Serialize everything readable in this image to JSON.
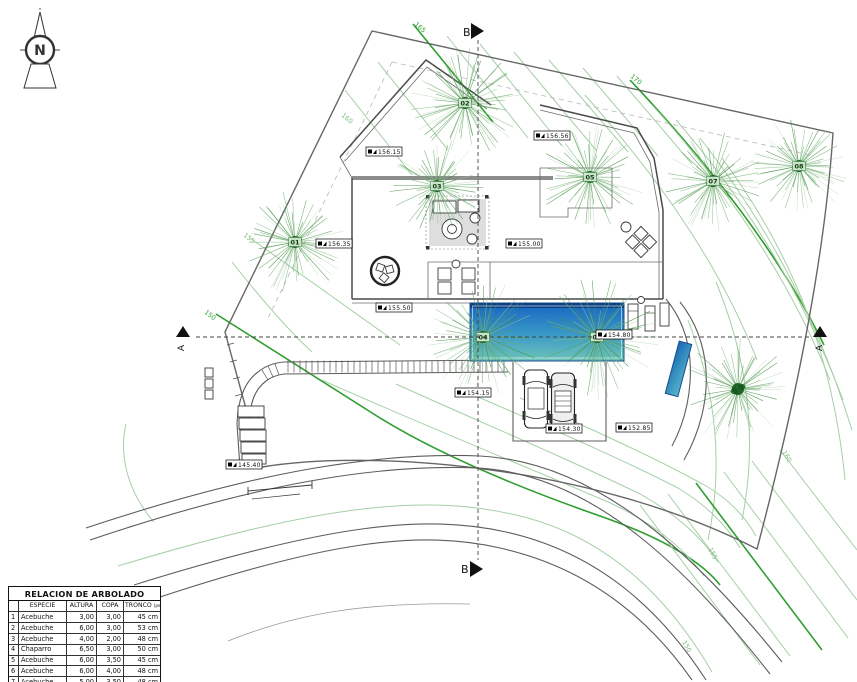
{
  "plan": {
    "compass_label": "N",
    "section_a": "A",
    "section_b": "B",
    "contour_labels": [
      {
        "text": "165",
        "x": 414,
        "y": 25,
        "bright": true,
        "rot": 40
      },
      {
        "text": "170",
        "x": 630,
        "y": 77,
        "bright": true,
        "rot": 40
      },
      {
        "text": "160",
        "x": 341,
        "y": 116,
        "bright": false,
        "rot": 40
      },
      {
        "text": "155",
        "x": 243,
        "y": 236,
        "bright": false,
        "rot": 38
      },
      {
        "text": "150",
        "x": 204,
        "y": 313,
        "bright": true,
        "rot": 38
      },
      {
        "text": "160",
        "x": 782,
        "y": 452,
        "bright": false,
        "rot": 60
      },
      {
        "text": "155",
        "x": 708,
        "y": 549,
        "bright": false,
        "rot": 62
      },
      {
        "text": "150",
        "x": 682,
        "y": 642,
        "bright": false,
        "rot": 62
      }
    ],
    "trees": [
      {
        "id": "01",
        "x": 295,
        "y": 242,
        "r": 52
      },
      {
        "id": "02",
        "x": 465,
        "y": 103,
        "r": 55
      },
      {
        "id": "03",
        "x": 437,
        "y": 186,
        "r": 48
      },
      {
        "id": "04",
        "x": 483,
        "y": 337,
        "r": 56
      },
      {
        "id": "05",
        "x": 590,
        "y": 177,
        "r": 52
      },
      {
        "id": "06",
        "x": 597,
        "y": 337,
        "r": 60
      },
      {
        "id": "07",
        "x": 713,
        "y": 181,
        "r": 50
      },
      {
        "id": "08",
        "x": 799,
        "y": 166,
        "r": 48
      },
      {
        "id": "",
        "x": 738,
        "y": 389,
        "r": 54
      }
    ],
    "elevation_labels": [
      {
        "value": "156.15",
        "x": 366,
        "y": 147
      },
      {
        "value": "156.35",
        "x": 316,
        "y": 239
      },
      {
        "value": "156.56",
        "x": 534,
        "y": 131
      },
      {
        "value": "155.00",
        "x": 506,
        "y": 239
      },
      {
        "value": "155.50",
        "x": 376,
        "y": 303
      },
      {
        "value": "154.80",
        "x": 596,
        "y": 330
      },
      {
        "value": "154.15",
        "x": 455,
        "y": 388
      },
      {
        "value": "154.30",
        "x": 546,
        "y": 424
      },
      {
        "value": "152.85",
        "x": 616,
        "y": 423
      },
      {
        "value": "145.40",
        "x": 226,
        "y": 460
      }
    ]
  },
  "table": {
    "title": "RELACION DE ARBOLADO",
    "col_num": "",
    "col_especie": "ESPECIE",
    "col_altura": "ALTURA",
    "col_copa": "COPA",
    "col_tronco": "TRONCO",
    "col_tronco_sub": "(perimetro)",
    "rows": [
      {
        "n": "1",
        "especie": "Acebuche",
        "altura": "3,00",
        "copa": "3,00",
        "tronco": "45 cm"
      },
      {
        "n": "2",
        "especie": "Acebuche",
        "altura": "6,00",
        "copa": "3,00",
        "tronco": "53 cm"
      },
      {
        "n": "3",
        "especie": "Acebuche",
        "altura": "4,00",
        "copa": "2,00",
        "tronco": "48 cm"
      },
      {
        "n": "4",
        "especie": "Chaparro",
        "altura": "6,50",
        "copa": "3,00",
        "tronco": "50 cm"
      },
      {
        "n": "5",
        "especie": "Acebuche",
        "altura": "6,00",
        "copa": "3,50",
        "tronco": "45 cm"
      },
      {
        "n": "6",
        "especie": "Acebuche",
        "altura": "6,00",
        "copa": "4,00",
        "tronco": "48 cm"
      },
      {
        "n": "7",
        "especie": "Acebuche",
        "altura": "5,00",
        "copa": "3,50",
        "tronco": "48 cm"
      },
      {
        "n": "8",
        "especie": "Acebuche",
        "altura": "5,00",
        "copa": "3,50",
        "tronco": "45 cm"
      }
    ]
  },
  "colors": {
    "contour_bright": "#2f9e2f",
    "contour_light": "#7db87d",
    "tree_stroke": "#4f9b4f",
    "tree_center": "#14591c",
    "pool_top": "#1565c0",
    "pool_mid": "#3b9ac8",
    "pool_bottom": "#6cc4b8",
    "wall": "#4a4a4a"
  }
}
